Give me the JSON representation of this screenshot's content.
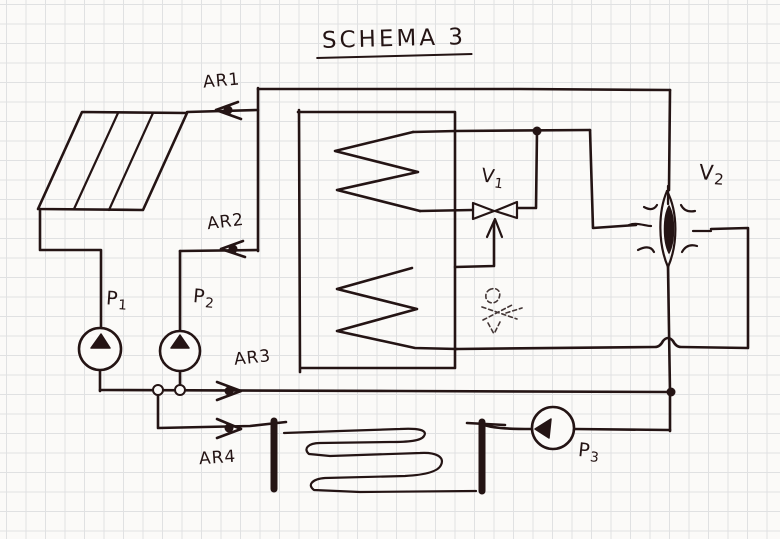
{
  "diagram": {
    "title": "SCHEMA 3",
    "labels": {
      "ar1": "AR1",
      "ar2": "AR2",
      "ar3": "AR3",
      "ar4": "AR4"
    },
    "pumps": {
      "p1": {
        "letter": "P",
        "sub": "1"
      },
      "p2": {
        "letter": "P",
        "sub": "2"
      },
      "p3": {
        "letter": "P",
        "sub": "3"
      }
    },
    "valves": {
      "v1": {
        "letter": "V",
        "sub": "1"
      },
      "v2": {
        "letter": "V",
        "sub": "2"
      }
    }
  },
  "colors": {
    "ink": "#241414",
    "paper": "#fbfaf8",
    "grid": "#e0e1e2",
    "ghost": "#9b8877"
  }
}
